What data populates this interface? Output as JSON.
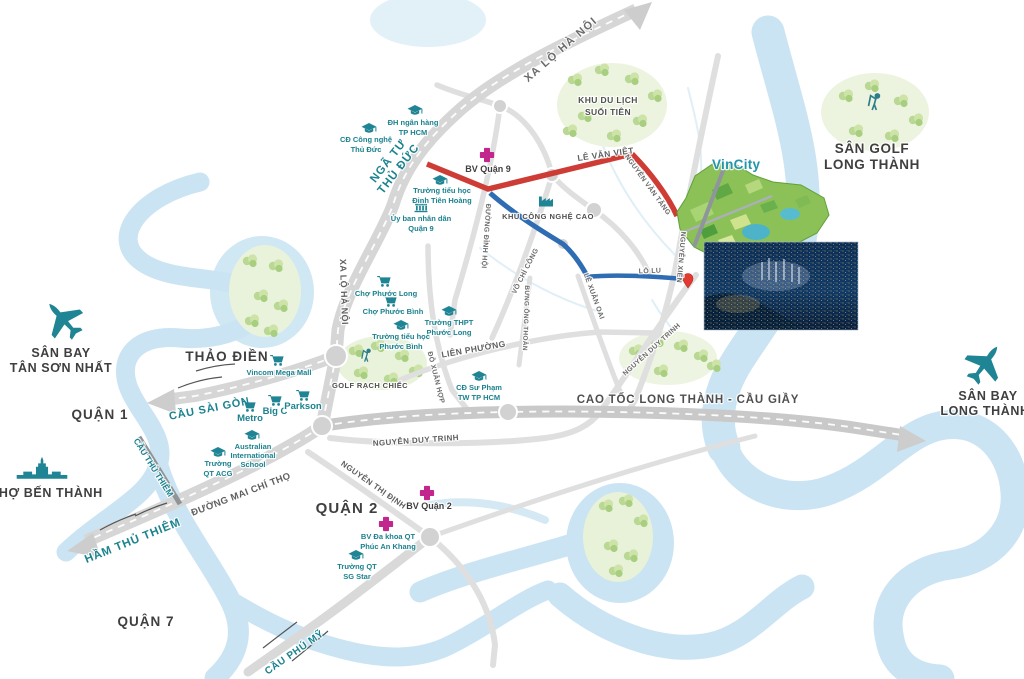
{
  "colors": {
    "teal_accent": "#1f8494",
    "teal_label": "#1b828f",
    "magenta_hospital": "#c1278d",
    "red_road": "#ce3c36",
    "blue_road": "#2e6cb4",
    "river": "#cbe4f3",
    "road_gray": "#d6d6d6",
    "green_area": "#ebf3dd",
    "vincity_label": "#2095ac",
    "pin_red": "#e23a30"
  },
  "icons": {
    "school": "graduation-cap",
    "market": "shopping-cart",
    "hospital": "medical-cross",
    "industry": "factory",
    "government": "columned-building",
    "airport": "airplane",
    "golf": "golfer-swinging",
    "ben_thanh": "market-gate-silhouette",
    "location": "red-map-pin"
  },
  "districts": {
    "quan_1": "QUẬN 1",
    "quan_2": "QUẬN 2",
    "quan_7": "QUẬN 7",
    "thao_dien": "THẢO ĐIỀN"
  },
  "airports": {
    "tan_son_nhat_1": "SÂN BAY",
    "tan_son_nhat_2": "TÂN SƠN NHẤT",
    "long_thanh_1": "SÂN BAY",
    "long_thanh_2": "LONG THÀNH"
  },
  "landmarks": {
    "vincity": "VinCity",
    "suoi_tien_1": "KHU DU LỊCH",
    "suoi_tien_2": "SUỐI TIÊN",
    "golf_long_thanh_1": "SÂN GOLF",
    "golf_long_thanh_2": "LONG THÀNH",
    "golf_rach_chiec": "GOLF RẠCH CHIẾC",
    "cho_ben_thanh": "CHỢ BẾN THÀNH",
    "khu_cong_nghe_cao": "KHU CÔNG NGHỆ CAO"
  },
  "roads": {
    "xa_lo_ha_noi": "XA LỘ HÀ NỘI",
    "nga_tu_1": "NGÃ TƯ",
    "nga_tu_2": "THỦ ĐỨC",
    "le_van_viet": "LÊ VĂN VIỆT",
    "nguyen_van_tang": "NGUYỄN VĂN TĂNG",
    "nguyen_xien": "NGUYỄN XIỂN",
    "lo_lu": "LÒ LU",
    "duong_dinh_hoi": "ĐƯỜNG ĐÌNH HỘI",
    "vo_chi_cong": "VÕ CHÍ CÔNG",
    "le_xuan_oai": "LÊ XUÂN OAI",
    "bung_ong_thoan": "BƯNG ÔNG THOÀN",
    "do_xuan_hop": "ĐỖ XUÂN HỢP",
    "lien_phuong": "LIÊN PHƯỜNG",
    "cao_toc": "CAO TỐC LONG THÀNH - CẦU GIẦY",
    "nguyen_duy_trinh": "NGUYỄN DUY TRINH",
    "nguyen_thi_dinh": "NGUYỄN THỊ ĐỊNH",
    "mai_chi_tho": "ĐƯỜNG MAI CHÍ THỌ",
    "cau_sai_gon": "CẦU SÀI GÒN",
    "cau_thu_thiem": "CẦU THỦ THIÊM",
    "ham_thu_thiem": "HẦM THỦ THIÊM",
    "cau_phu_my": "CẦU PHÚ MỸ"
  },
  "pois": {
    "dh_ngan_hang_1": "ĐH ngân hàng",
    "dh_ngan_hang_2": "TP HCM",
    "cd_cong_nghe_1": "CĐ Công nghệ",
    "cd_cong_nghe_2": "Thủ Đức",
    "bv_quan_9": "BV Quận 9",
    "th_dinh_tien_hoang_1": "Trường tiểu học",
    "th_dinh_tien_hoang_2": "Đinh Tiên Hoàng",
    "uy_ban_q9_1": "Ủy ban nhân dân",
    "uy_ban_q9_2": "Quận 9",
    "cho_phuoc_long": "Chợ Phước Long",
    "cho_phuoc_binh": "Chợ Phước Bình",
    "thpt_phuoc_long_1": "Trường THPT",
    "thpt_phuoc_long_2": "Phước Long",
    "th_phuoc_binh_1": "Trường tiểu học",
    "th_phuoc_binh_2": "Phước Bình",
    "vincom": "Vincom Mega Mall",
    "metro": "Metro",
    "big_c": "Big C",
    "parkson": "Parkson",
    "cd_su_pham_1": "CĐ Sư Phạm",
    "cd_su_pham_2": "TW TP HCM",
    "truong_acg_1": "Trường",
    "truong_acg_2": "QT ACG",
    "australian_1": "Australian",
    "australian_2": "International",
    "australian_3": "School",
    "bv_quan_2": "BV Quận 2",
    "bv_phuc_an_khang_1": "BV Đa khoa QT",
    "bv_phuc_an_khang_2": "Phúc An Khang",
    "sg_star_1": "Trường QT",
    "sg_star_2": "SG Star"
  }
}
